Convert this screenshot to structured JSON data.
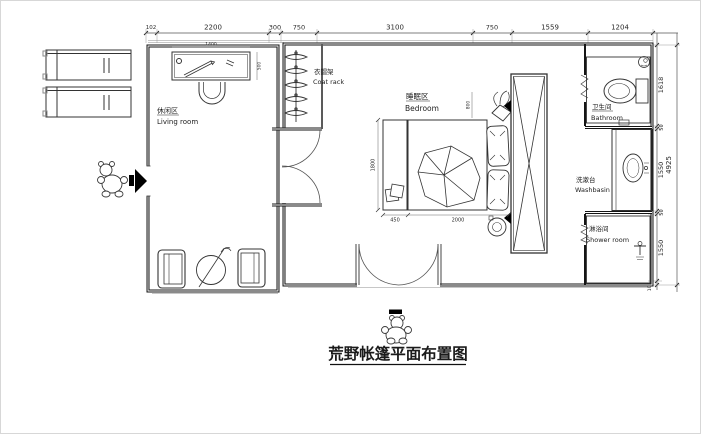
{
  "title": {
    "text": "荒野帐篷平面布置图"
  },
  "labels": {
    "living": {
      "zh": "休闲区",
      "en": "Living room"
    },
    "coat_rack": {
      "zh": "衣帽架",
      "en": "Coat rack"
    },
    "bedroom": {
      "zh": "睡眠区",
      "en": "Bedroom"
    },
    "bathroom": {
      "zh": "卫生间",
      "en": "Bathroom"
    },
    "washbasin": {
      "zh": "洗漱台",
      "en": "Washbasin"
    },
    "shower": {
      "zh": "淋浴间",
      "en": "Shower room"
    }
  },
  "dims": {
    "top": [
      "102",
      "2200",
      "300",
      "750",
      "3100",
      "750",
      "1559",
      "1204"
    ],
    "right": [
      "1618",
      "50",
      "1550",
      "50",
      "1550",
      "107"
    ],
    "right_total": "4925",
    "bed_platform": "450",
    "bed_width": "2000",
    "bed_length": "1800",
    "plant_nook": "800",
    "desk_width": "1400",
    "desk_depth": "500"
  },
  "colors": {
    "wall": "#151515",
    "furniture": "#333333",
    "dimline": "#555555",
    "faint": "#b5b5b5"
  }
}
